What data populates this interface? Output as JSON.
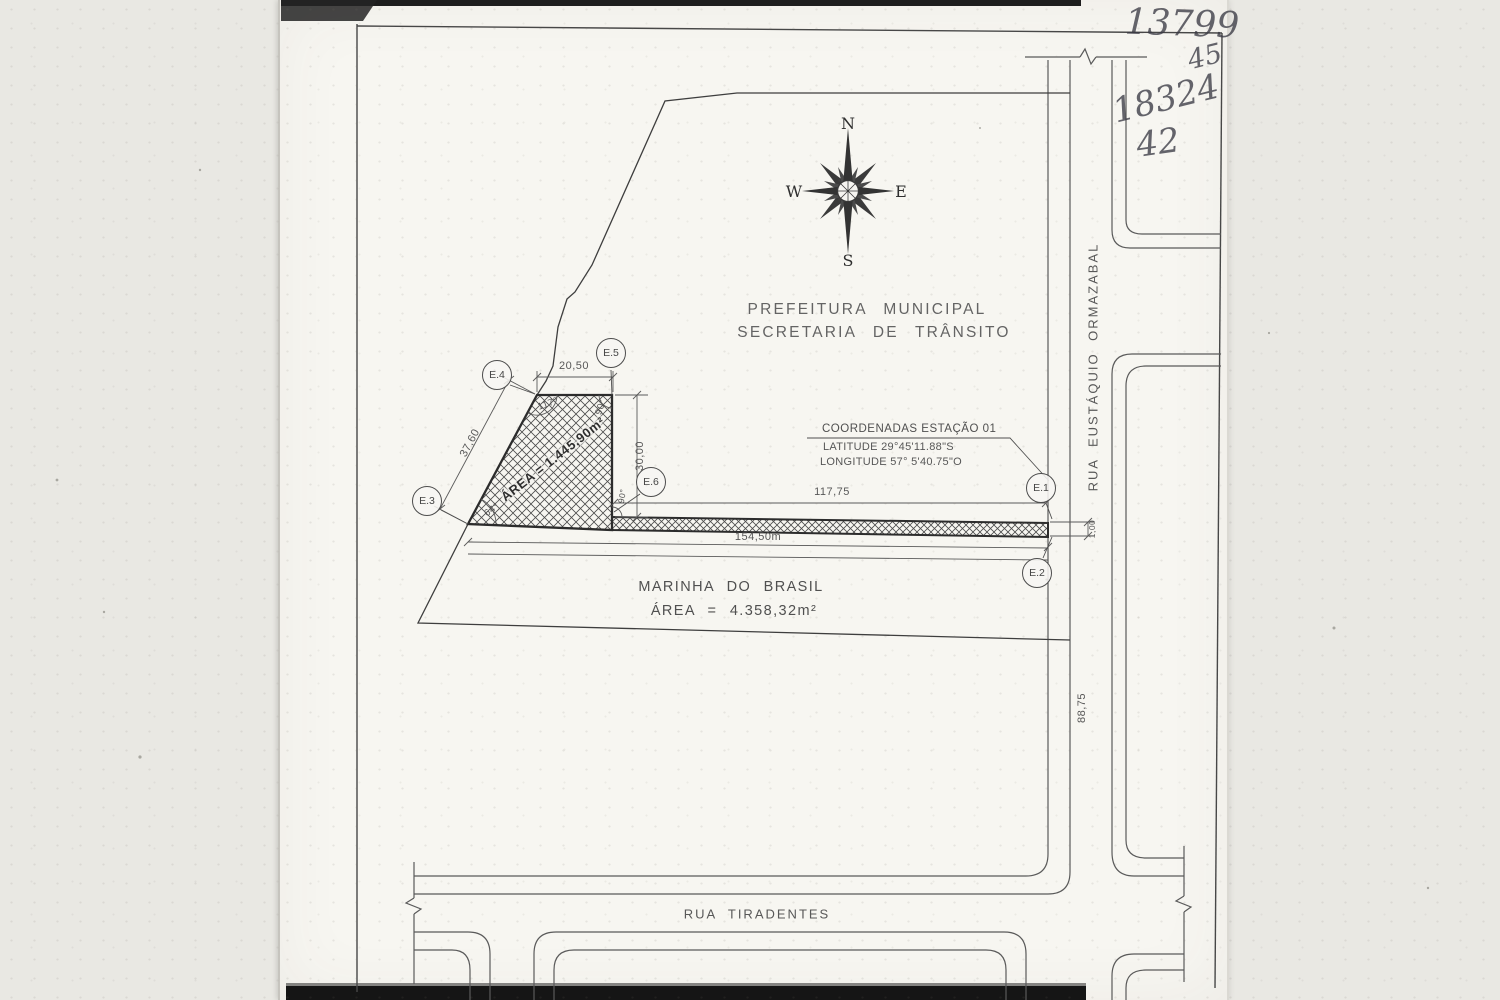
{
  "handwriting": {
    "n1": "13799",
    "n2": "45",
    "n3": "18324",
    "n4": "42"
  },
  "compass": {
    "n": "N",
    "e": "E",
    "s": "S",
    "w": "W"
  },
  "title": {
    "line1": "PREFEITURA MUNICIPAL",
    "line2": "SECRETARIA DE TRÂNSITO"
  },
  "coordinates": {
    "heading": "COORDENADAS ESTAÇÃO 01",
    "latitude": "LATITUDE 29°45'11.88\"S",
    "longitude": "LONGITUDE 57° 5'40.75\"O"
  },
  "parcel": {
    "area_label": "ÁREA = 1.445,90m²"
  },
  "marinha": {
    "line1": "MARINHA DO BRASIL",
    "line2": "ÁREA = 4.358,32m²"
  },
  "streets": {
    "east": "RUA EUSTÁQUIO ORMAZABAL",
    "south": "RUA TIRADENTES"
  },
  "stations": {
    "e1": "E.1",
    "e2": "E.2",
    "e3": "E.3",
    "e4": "E.4",
    "e5": "E.5",
    "e6": "E.6"
  },
  "dimensions": {
    "top_width": "20,50",
    "left_side": "37,60",
    "right_side": "30,00",
    "strip_length": "117,75",
    "base_length": "154,50m",
    "strip_width": "1,00",
    "street_length": "88,75"
  },
  "angles": {
    "e4": "117°",
    "e5": "90°",
    "e3": "64°",
    "e6": "90°"
  },
  "colors": {
    "ink": "#4a4a4a",
    "paper": "#f7f6f1",
    "background": "#e9e8e3"
  }
}
